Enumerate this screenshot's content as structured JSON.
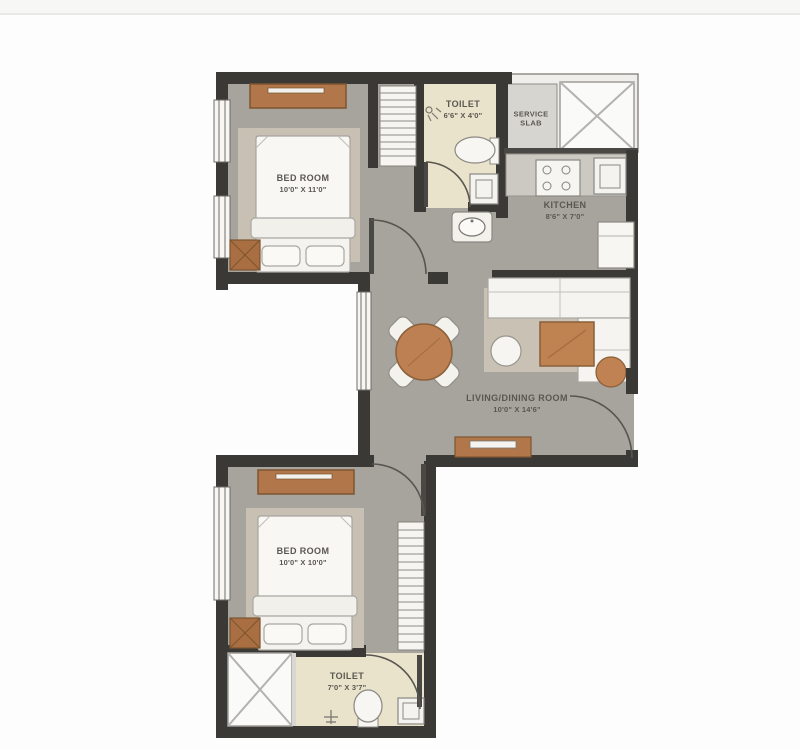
{
  "page": {
    "background": "#fdfdfd",
    "top_divider_color": "#e8e8e6"
  },
  "plan": {
    "rooms": {
      "bedroom1": {
        "name": "BED ROOM",
        "dims": "10'0\" X 11'0\""
      },
      "toilet1": {
        "name": "TOILET",
        "dims": "6'6\" X 4'0\""
      },
      "service_slab": {
        "name_line1": "SERVICE",
        "name_line2": "SLAB"
      },
      "kitchen": {
        "name": "KITCHEN",
        "dims": "8'6\" X 7'0\""
      },
      "living_dining": {
        "name": "LIVING/DINING ROOM",
        "dims": "10'0\" X 14'6\""
      },
      "bedroom2": {
        "name": "BED ROOM",
        "dims": "10'0\" X 10'0\""
      },
      "toilet2": {
        "name": "TOILET",
        "dims": "7'0\" X 3'7\""
      }
    },
    "palette": {
      "wall": "#3b3936",
      "floor_gray": "#a7a49e",
      "toilet_floor": "#e9e3cc",
      "rug": "#c8c1b3",
      "wood": "#b1774a",
      "wood_dark": "#7d552f",
      "furniture_white": "#f4f3ef",
      "service_slab": "#d7d5d0",
      "shaft_white": "#fafaf8",
      "label_text": "#5a5750"
    },
    "icons": [
      "double-bed-icon",
      "wardrobe-shelves-icon",
      "dresser-icon",
      "bedside-table-icon",
      "wc-toilet-icon",
      "washbasin-icon",
      "shower-icon",
      "kitchen-hob-icon",
      "kitchen-sink-icon",
      "fridge-icon",
      "dining-table-icon",
      "dining-chair-icon",
      "sofa-icon",
      "coffee-table-icon",
      "side-table-icon",
      "pouf-icon",
      "tv-unit-icon",
      "door-swing-icon",
      "window-icon",
      "duct-shaft-icon"
    ]
  }
}
